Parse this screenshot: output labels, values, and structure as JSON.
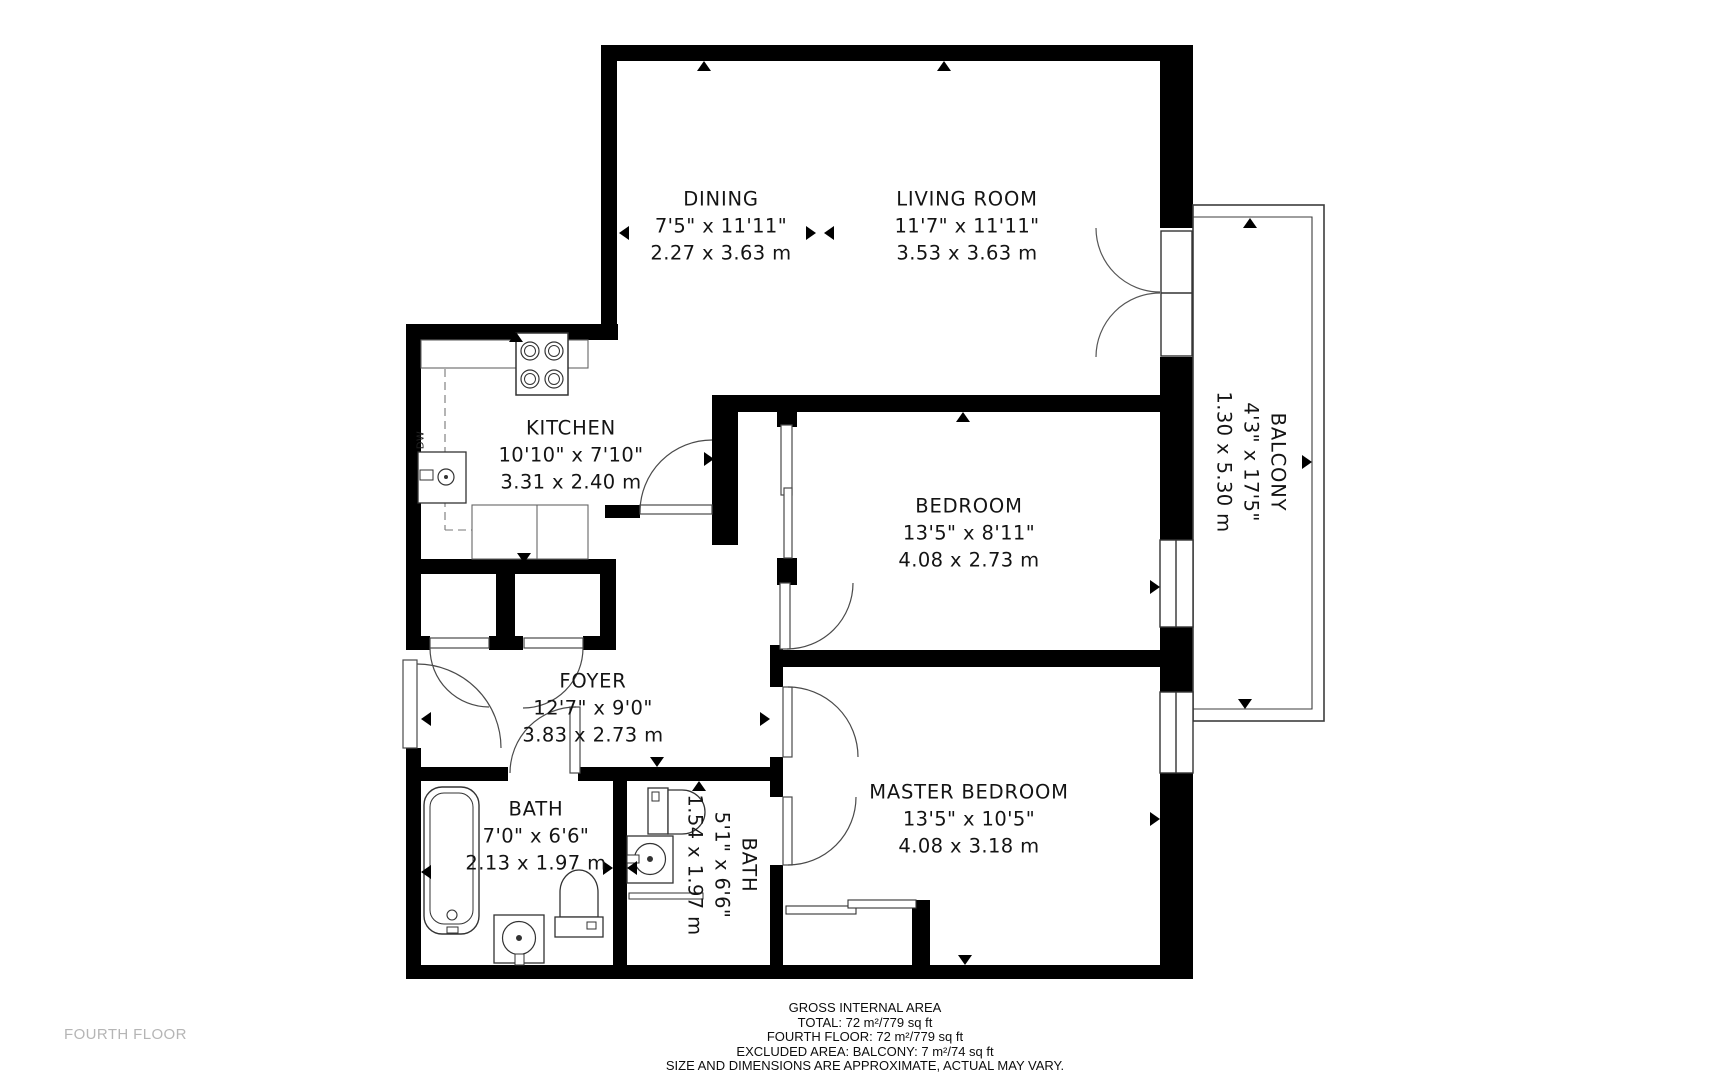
{
  "floor": {
    "label": "FOURTH FLOOR"
  },
  "rooms": {
    "dining": {
      "name": "DINING",
      "imperial": "7'5\" x 11'11\"",
      "metric": "2.27 x 3.63 m"
    },
    "living": {
      "name": "LIVING ROOM",
      "imperial": "11'7\" x 11'11\"",
      "metric": "3.53 x 3.63 m"
    },
    "kitchen": {
      "name": "KITCHEN",
      "imperial": "10'10\" x 7'10\"",
      "metric": "3.31 x 2.40 m"
    },
    "bedroom": {
      "name": "BEDROOM",
      "imperial": "13'5\" x 8'11\"",
      "metric": "4.08 x 2.73 m"
    },
    "foyer": {
      "name": "FOYER",
      "imperial": "12'7\" x 9'0\"",
      "metric": "3.83 x 2.73 m"
    },
    "bath1": {
      "name": "BATH",
      "imperial": "7'0\" x 6'6\"",
      "metric": "2.13 x 1.97 m"
    },
    "bath2": {
      "name": "BATH",
      "imperial": "5'1\" x 6'6\"",
      "metric": "1.54 x 1.97 m"
    },
    "master": {
      "name": "MASTER BEDROOM",
      "imperial": "13'5\" x 10'5\"",
      "metric": "4.08 x 3.18 m"
    },
    "balcony": {
      "name": "BALCONY",
      "imperial": "4'3\" x 17'5\"",
      "metric": "1.30 x 5.30 m"
    }
  },
  "appliances": {
    "dishwasher": "DW"
  },
  "footer": {
    "lines": [
      "GROSS INTERNAL AREA",
      "TOTAL: 72 m²/779 sq ft",
      "FOURTH FLOOR: 72 m²/779 sq ft",
      "EXCLUDED AREA: BALCONY: 7 m²/74 sq ft",
      "SIZE AND DIMENSIONS ARE APPROXIMATE, ACTUAL MAY VARY."
    ]
  },
  "colors": {
    "wall": "#000000",
    "fixture_line": "#3a3a3a",
    "muted_text": "#b5b5b5",
    "background": "#ffffff"
  }
}
